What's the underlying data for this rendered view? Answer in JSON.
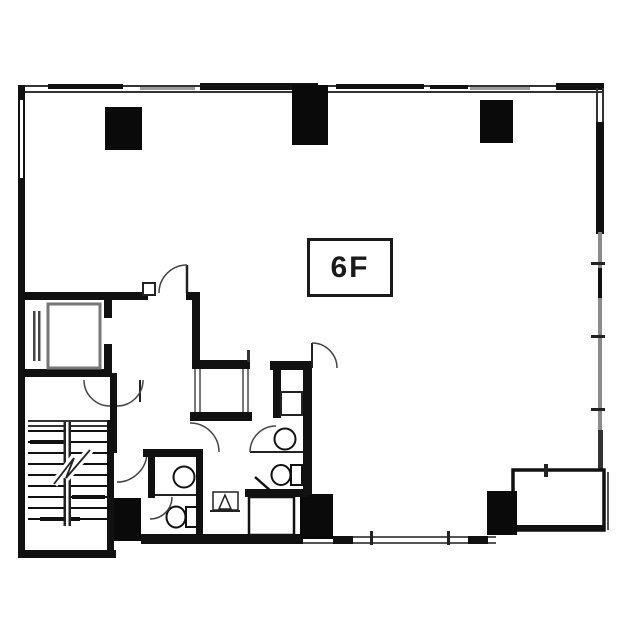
{
  "floor_label": {
    "text": "6F"
  },
  "drawing": {
    "background_color": "#ffffff",
    "wall_color": "#1a1a1a",
    "secondary_line_color": "#8a8a8a"
  }
}
